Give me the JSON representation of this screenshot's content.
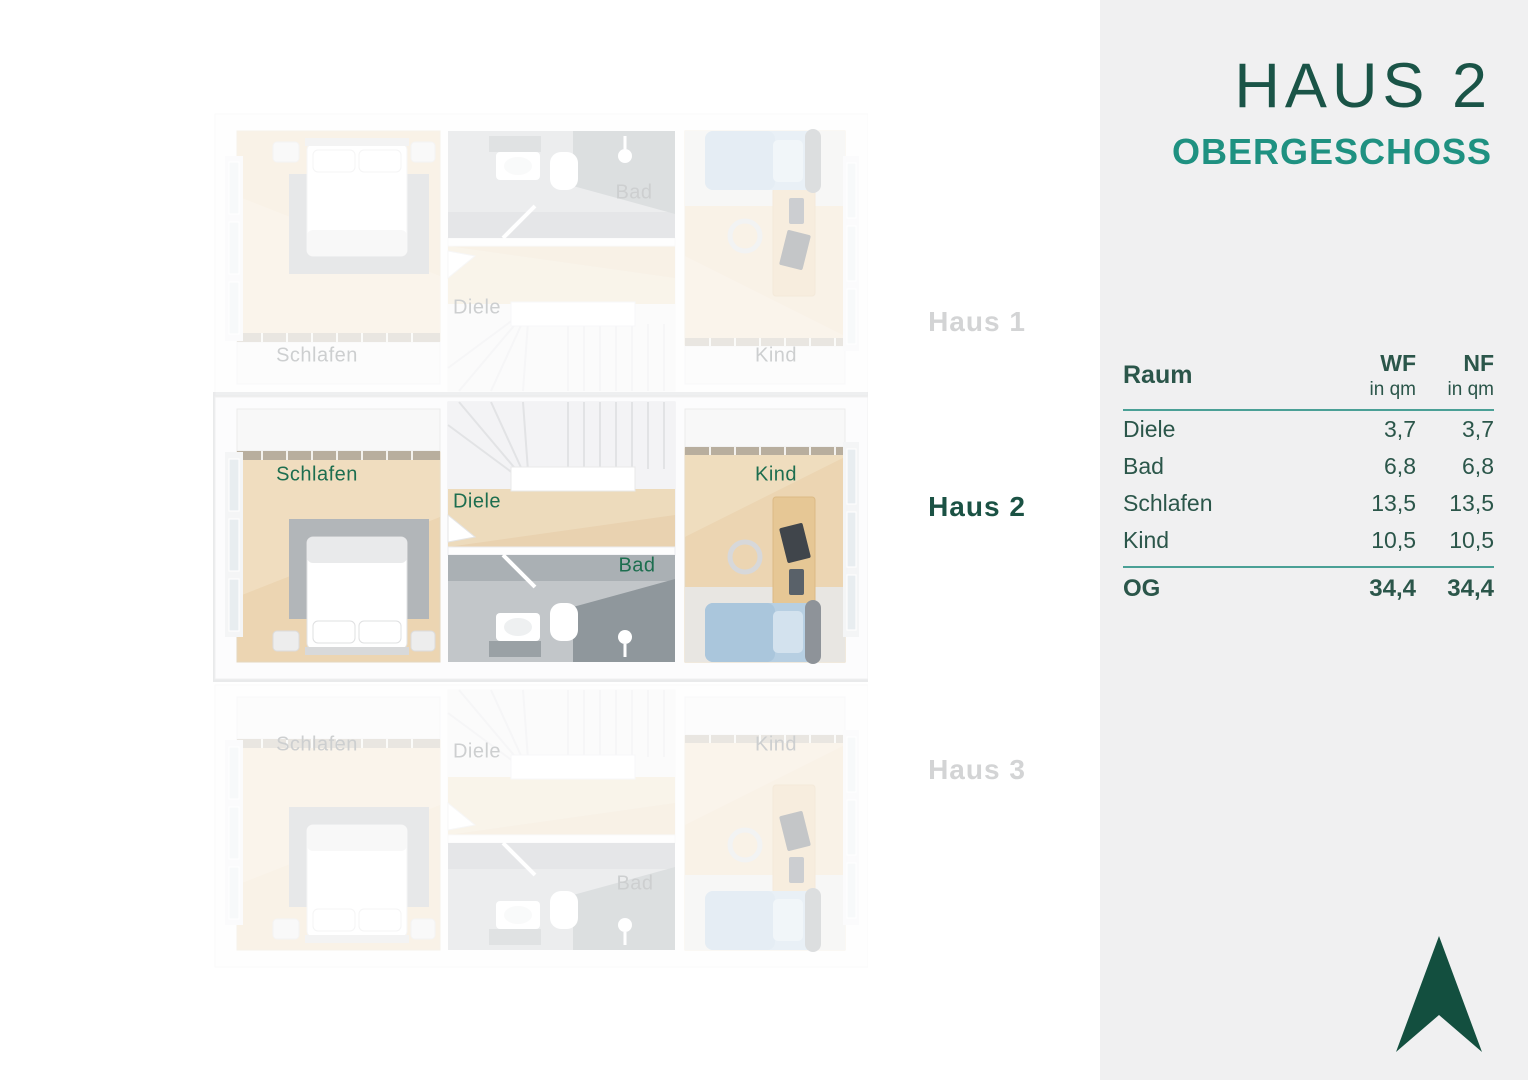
{
  "panel": {
    "title": "HAUS 2",
    "subtitle": "OBERGESCHOSS",
    "table": {
      "header": {
        "room": "Raum",
        "wf": "WF",
        "nf": "NF",
        "unit": "in qm"
      },
      "rows": [
        {
          "room": "Diele",
          "wf": "3,7",
          "nf": "3,7"
        },
        {
          "room": "Bad",
          "wf": "6,8",
          "nf": "6,8"
        },
        {
          "room": "Schlafen",
          "wf": "13,5",
          "nf": "13,5"
        },
        {
          "room": "Kind",
          "wf": "10,5",
          "nf": "10,5"
        }
      ],
      "total": {
        "room": "OG",
        "wf": "34,4",
        "nf": "34,4"
      }
    },
    "icons": {
      "north_arrow": "north-arrow"
    },
    "colors": {
      "dark_green": "#1a5447",
      "teal": "#1f9181",
      "rule_teal": "#4aa096",
      "panel_bg": "#f0f0f1",
      "plan_label_green": "#1d6e4f",
      "inactive_gray": "#d3d4d5",
      "arrow_green": "#134f3f"
    }
  },
  "plan": {
    "houses": [
      {
        "name": "Haus 1",
        "active": false,
        "rooms": {
          "schlafen": "Schlafen",
          "diele": "Diele",
          "bad": "Bad",
          "kind": "Kind"
        }
      },
      {
        "name": "Haus 2",
        "active": true,
        "rooms": {
          "schlafen": "Schlafen",
          "diele": "Diele",
          "bad": "Bad",
          "kind": "Kind"
        }
      },
      {
        "name": "Haus 3",
        "active": false,
        "rooms": {
          "schlafen": "Schlafen",
          "diele": "Diele",
          "bad": "Bad",
          "kind": "Kind"
        }
      }
    ]
  }
}
